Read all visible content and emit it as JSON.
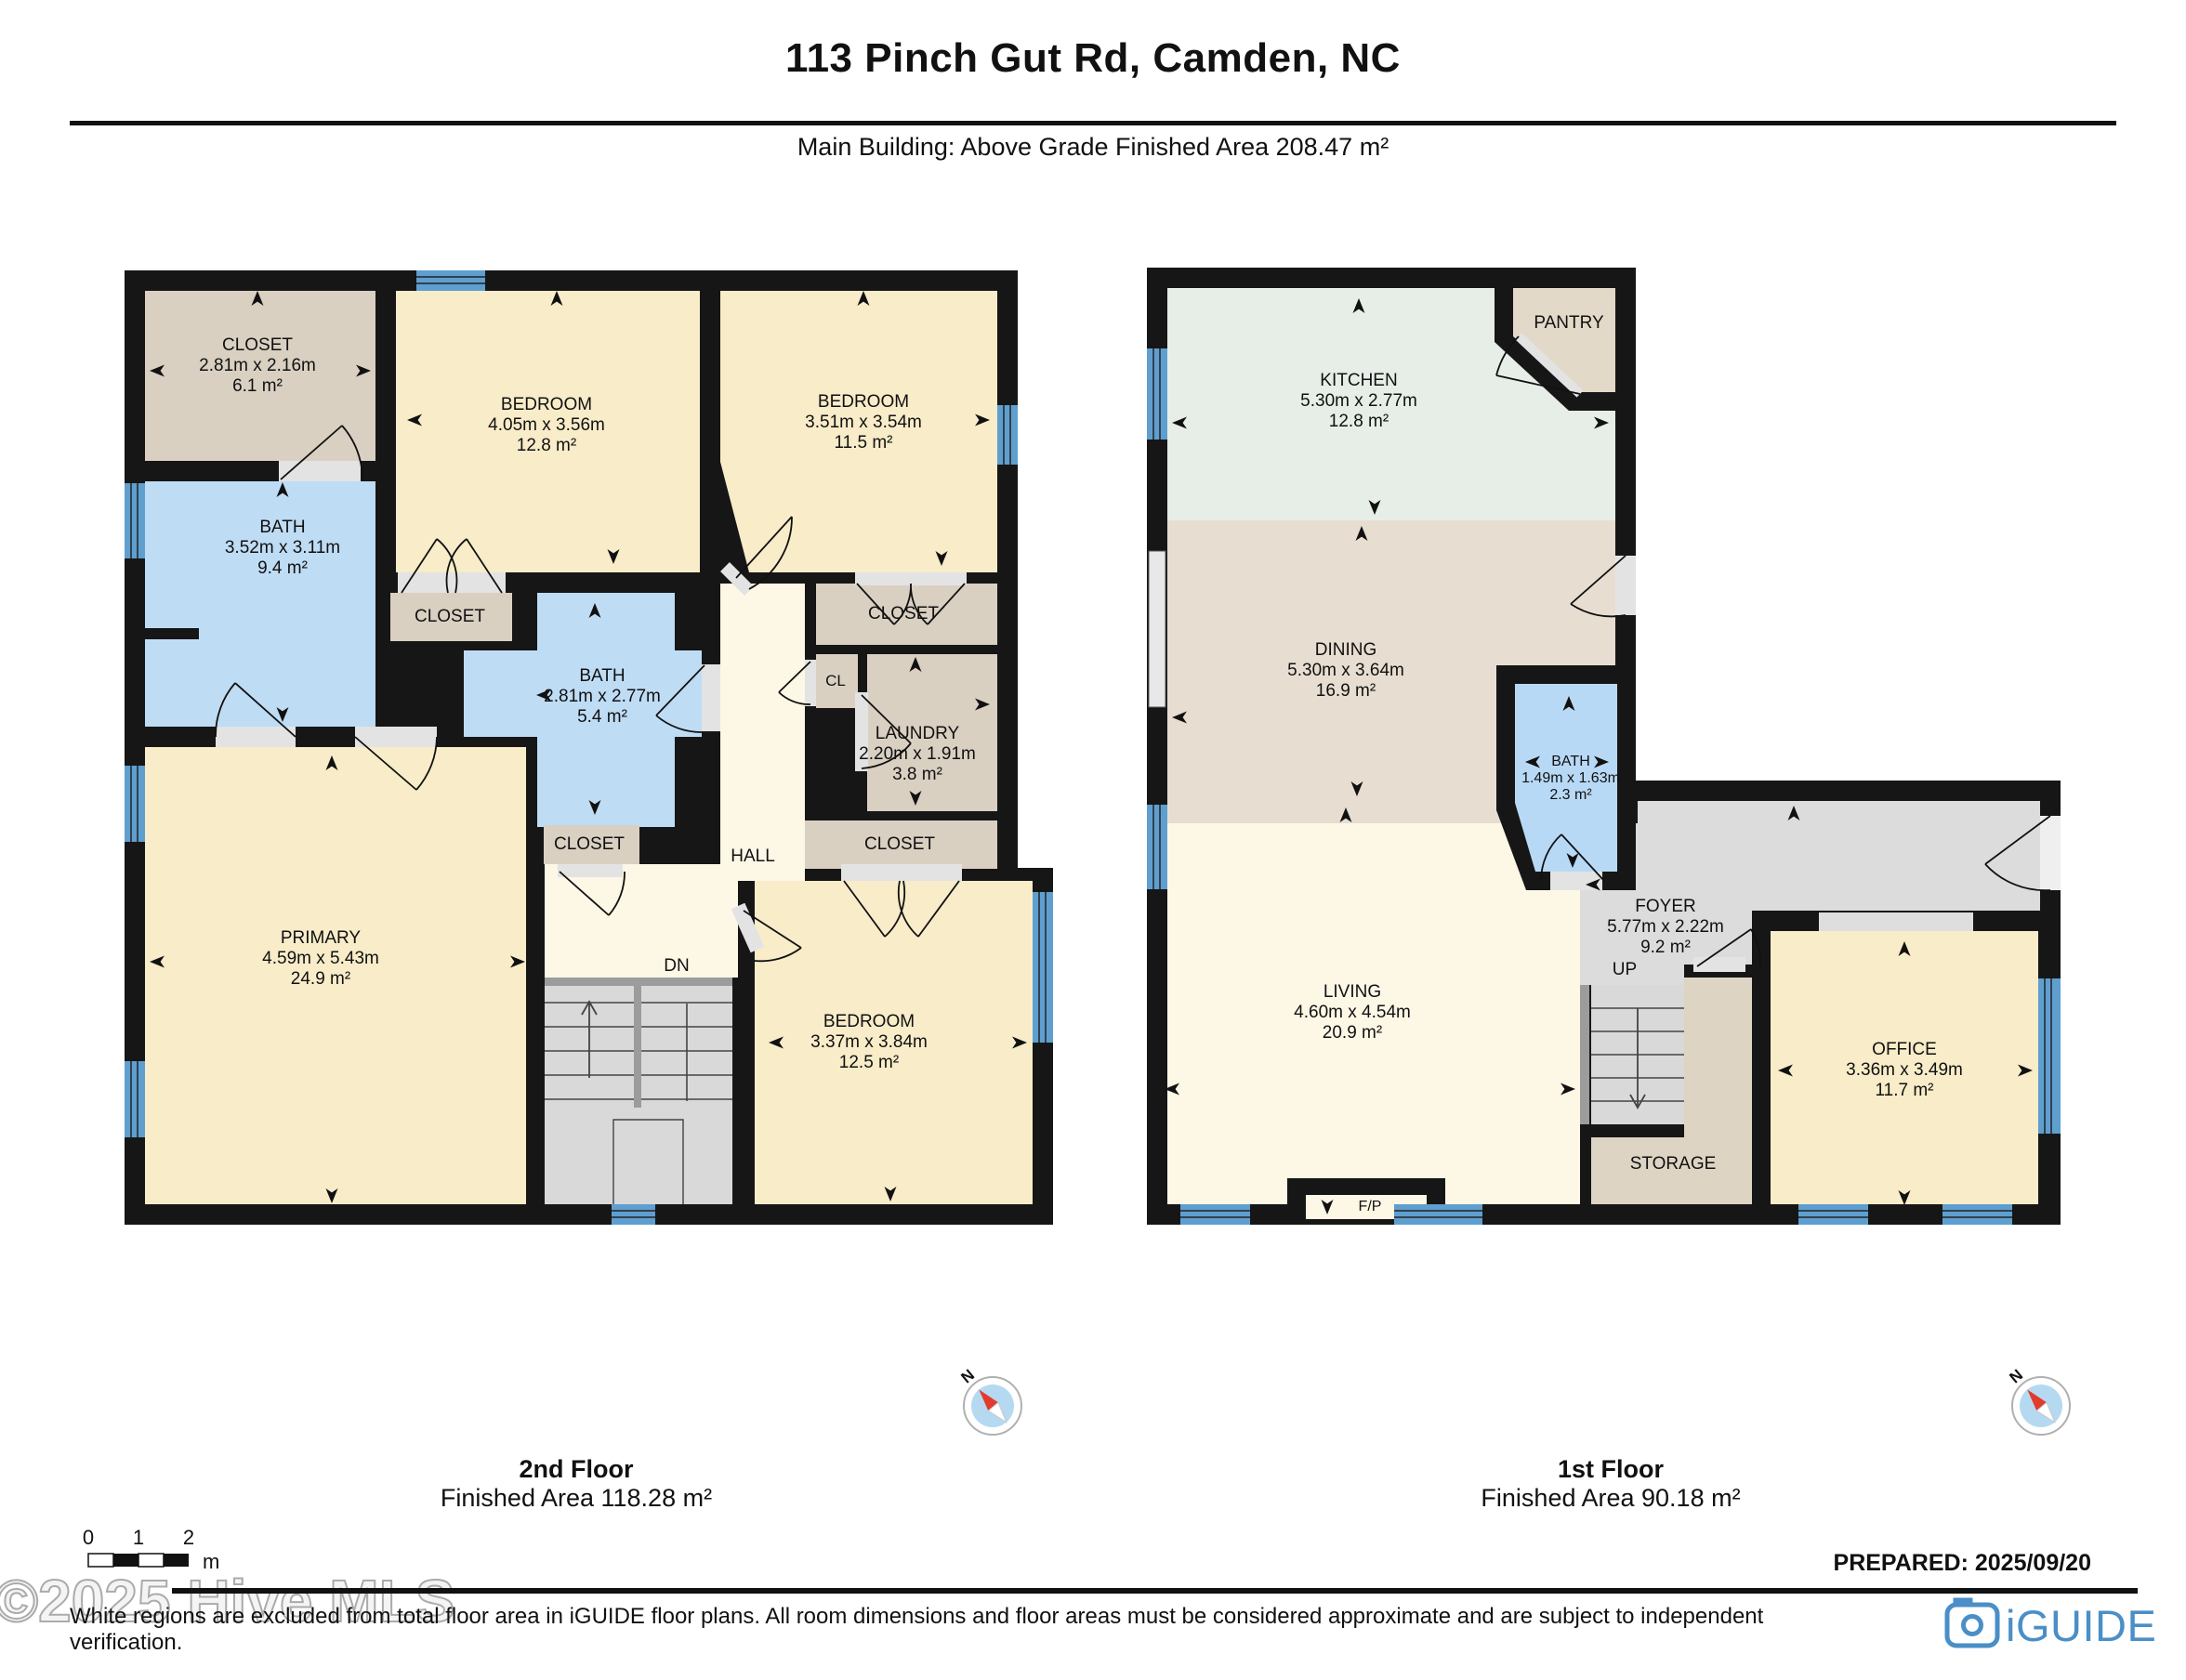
{
  "header": {
    "title": "113 Pinch Gut Rd, Camden, NC",
    "subtitle": "Main Building: Above Grade Finished Area 208.47 m²"
  },
  "floor2": {
    "name": "2nd Floor",
    "area": "Finished Area 118.28 m²",
    "rooms": {
      "closet_tl": {
        "name": "CLOSET",
        "dims": "2.81m x 2.16m",
        "area": "6.1 m²"
      },
      "bedroom_a": {
        "name": "BEDROOM",
        "dims": "4.05m x 3.56m",
        "area": "12.8 m²"
      },
      "bedroom_b": {
        "name": "BEDROOM",
        "dims": "3.51m x 3.54m",
        "area": "11.5 m²"
      },
      "bath_a": {
        "name": "BATH",
        "dims": "3.52m x 3.11m",
        "area": "9.4 m²"
      },
      "bath_b": {
        "name": "BATH",
        "dims": "2.81m x 2.77m",
        "area": "5.4 m²"
      },
      "laundry": {
        "name": "LAUNDRY",
        "dims": "2.20m x 1.91m",
        "area": "3.8 m²"
      },
      "primary": {
        "name": "PRIMARY",
        "dims": "4.59m x 5.43m",
        "area": "24.9 m²"
      },
      "bedroom_c": {
        "name": "BEDROOM",
        "dims": "3.37m x 3.84m",
        "area": "12.5 m²"
      },
      "closet": "CLOSET",
      "cl": "CL",
      "hall": "HALL",
      "dn": "DN"
    }
  },
  "floor1": {
    "name": "1st Floor",
    "area": "Finished Area 90.18 m²",
    "rooms": {
      "kitchen": {
        "name": "KITCHEN",
        "dims": "5.30m x 2.77m",
        "area": "12.8 m²"
      },
      "pantry": "PANTRY",
      "dining": {
        "name": "DINING",
        "dims": "5.30m x 3.64m",
        "area": "16.9 m²"
      },
      "bath": {
        "name": "BATH",
        "dims": "1.49m x 1.63m",
        "area": "2.3 m²"
      },
      "foyer": {
        "name": "FOYER",
        "dims": "5.77m x 2.22m",
        "area": "9.2 m²"
      },
      "living": {
        "name": "LIVING",
        "dims": "4.60m x 4.54m",
        "area": "20.9 m²"
      },
      "office": {
        "name": "OFFICE",
        "dims": "3.36m x 3.49m",
        "area": "11.7 m²"
      },
      "storage": "STORAGE",
      "up": "UP",
      "fp": "F/P"
    }
  },
  "compass": {
    "label": "N"
  },
  "scale_bar": {
    "ticks": [
      "0",
      "1",
      "2"
    ],
    "unit": "m"
  },
  "footer": {
    "watermark": "©2025 Hive MLS",
    "disclaimer": "White regions are excluded from total floor area in iGUIDE floor plans. All room dimensions and floor areas must be considered approximate and are subject to independent verification.",
    "prepared": "PREPARED: 2025/09/20",
    "brand": "iGUIDE"
  },
  "colors": {
    "wall": "#161616",
    "bedroom_cream": "#f8ecc9",
    "hall_cream": "#fdf7e6",
    "closet_tan": "#d9d0c2",
    "dining_tan": "#e7ded1",
    "storage_tan": "#ddd4c4",
    "bath_blue": "#bfdcf5",
    "kitchen_mint": "#e6eee7",
    "foyer_gray": "#dcdcdc",
    "stairs_gray": "#d9d9d9",
    "window_blue": "#5f9fd0",
    "brand_blue": "#4a8fc7",
    "compass_red": "#e23b2e"
  }
}
